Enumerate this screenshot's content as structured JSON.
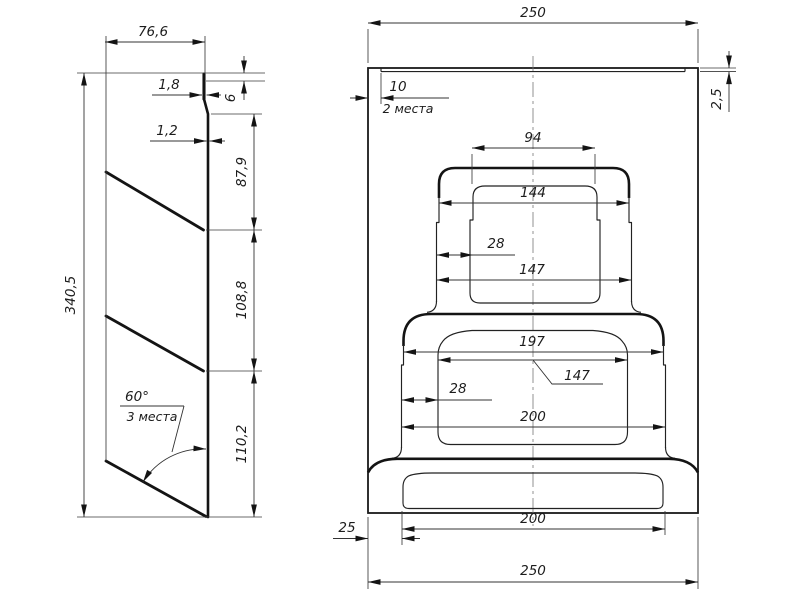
{
  "side_view": {
    "width_top": "76,6",
    "flange_thickness": "1,8",
    "flange_height": "6",
    "sheet_thickness": "1,2",
    "segment_1": "87,9",
    "segment_2": "108,8",
    "segment_3": "110,2",
    "total_height": "340,5",
    "louver_angle": "60°",
    "louver_angle_note": "3 места"
  },
  "front_view": {
    "overall_width_top": "250",
    "edge_offset": "10",
    "edge_offset_note": "2 места",
    "strip_thickness": "2,5",
    "boss1_inner_width": "94",
    "boss1_outer_width": "144",
    "boss1_wall": "28",
    "boss1_lower_width": "147",
    "boss2_outer_width": "197",
    "boss2_inner_width": "147",
    "boss2_wall": "28",
    "boss2_lower_width": "200",
    "base_offset": "25",
    "base_inner_width": "200",
    "overall_width_bottom": "250"
  }
}
